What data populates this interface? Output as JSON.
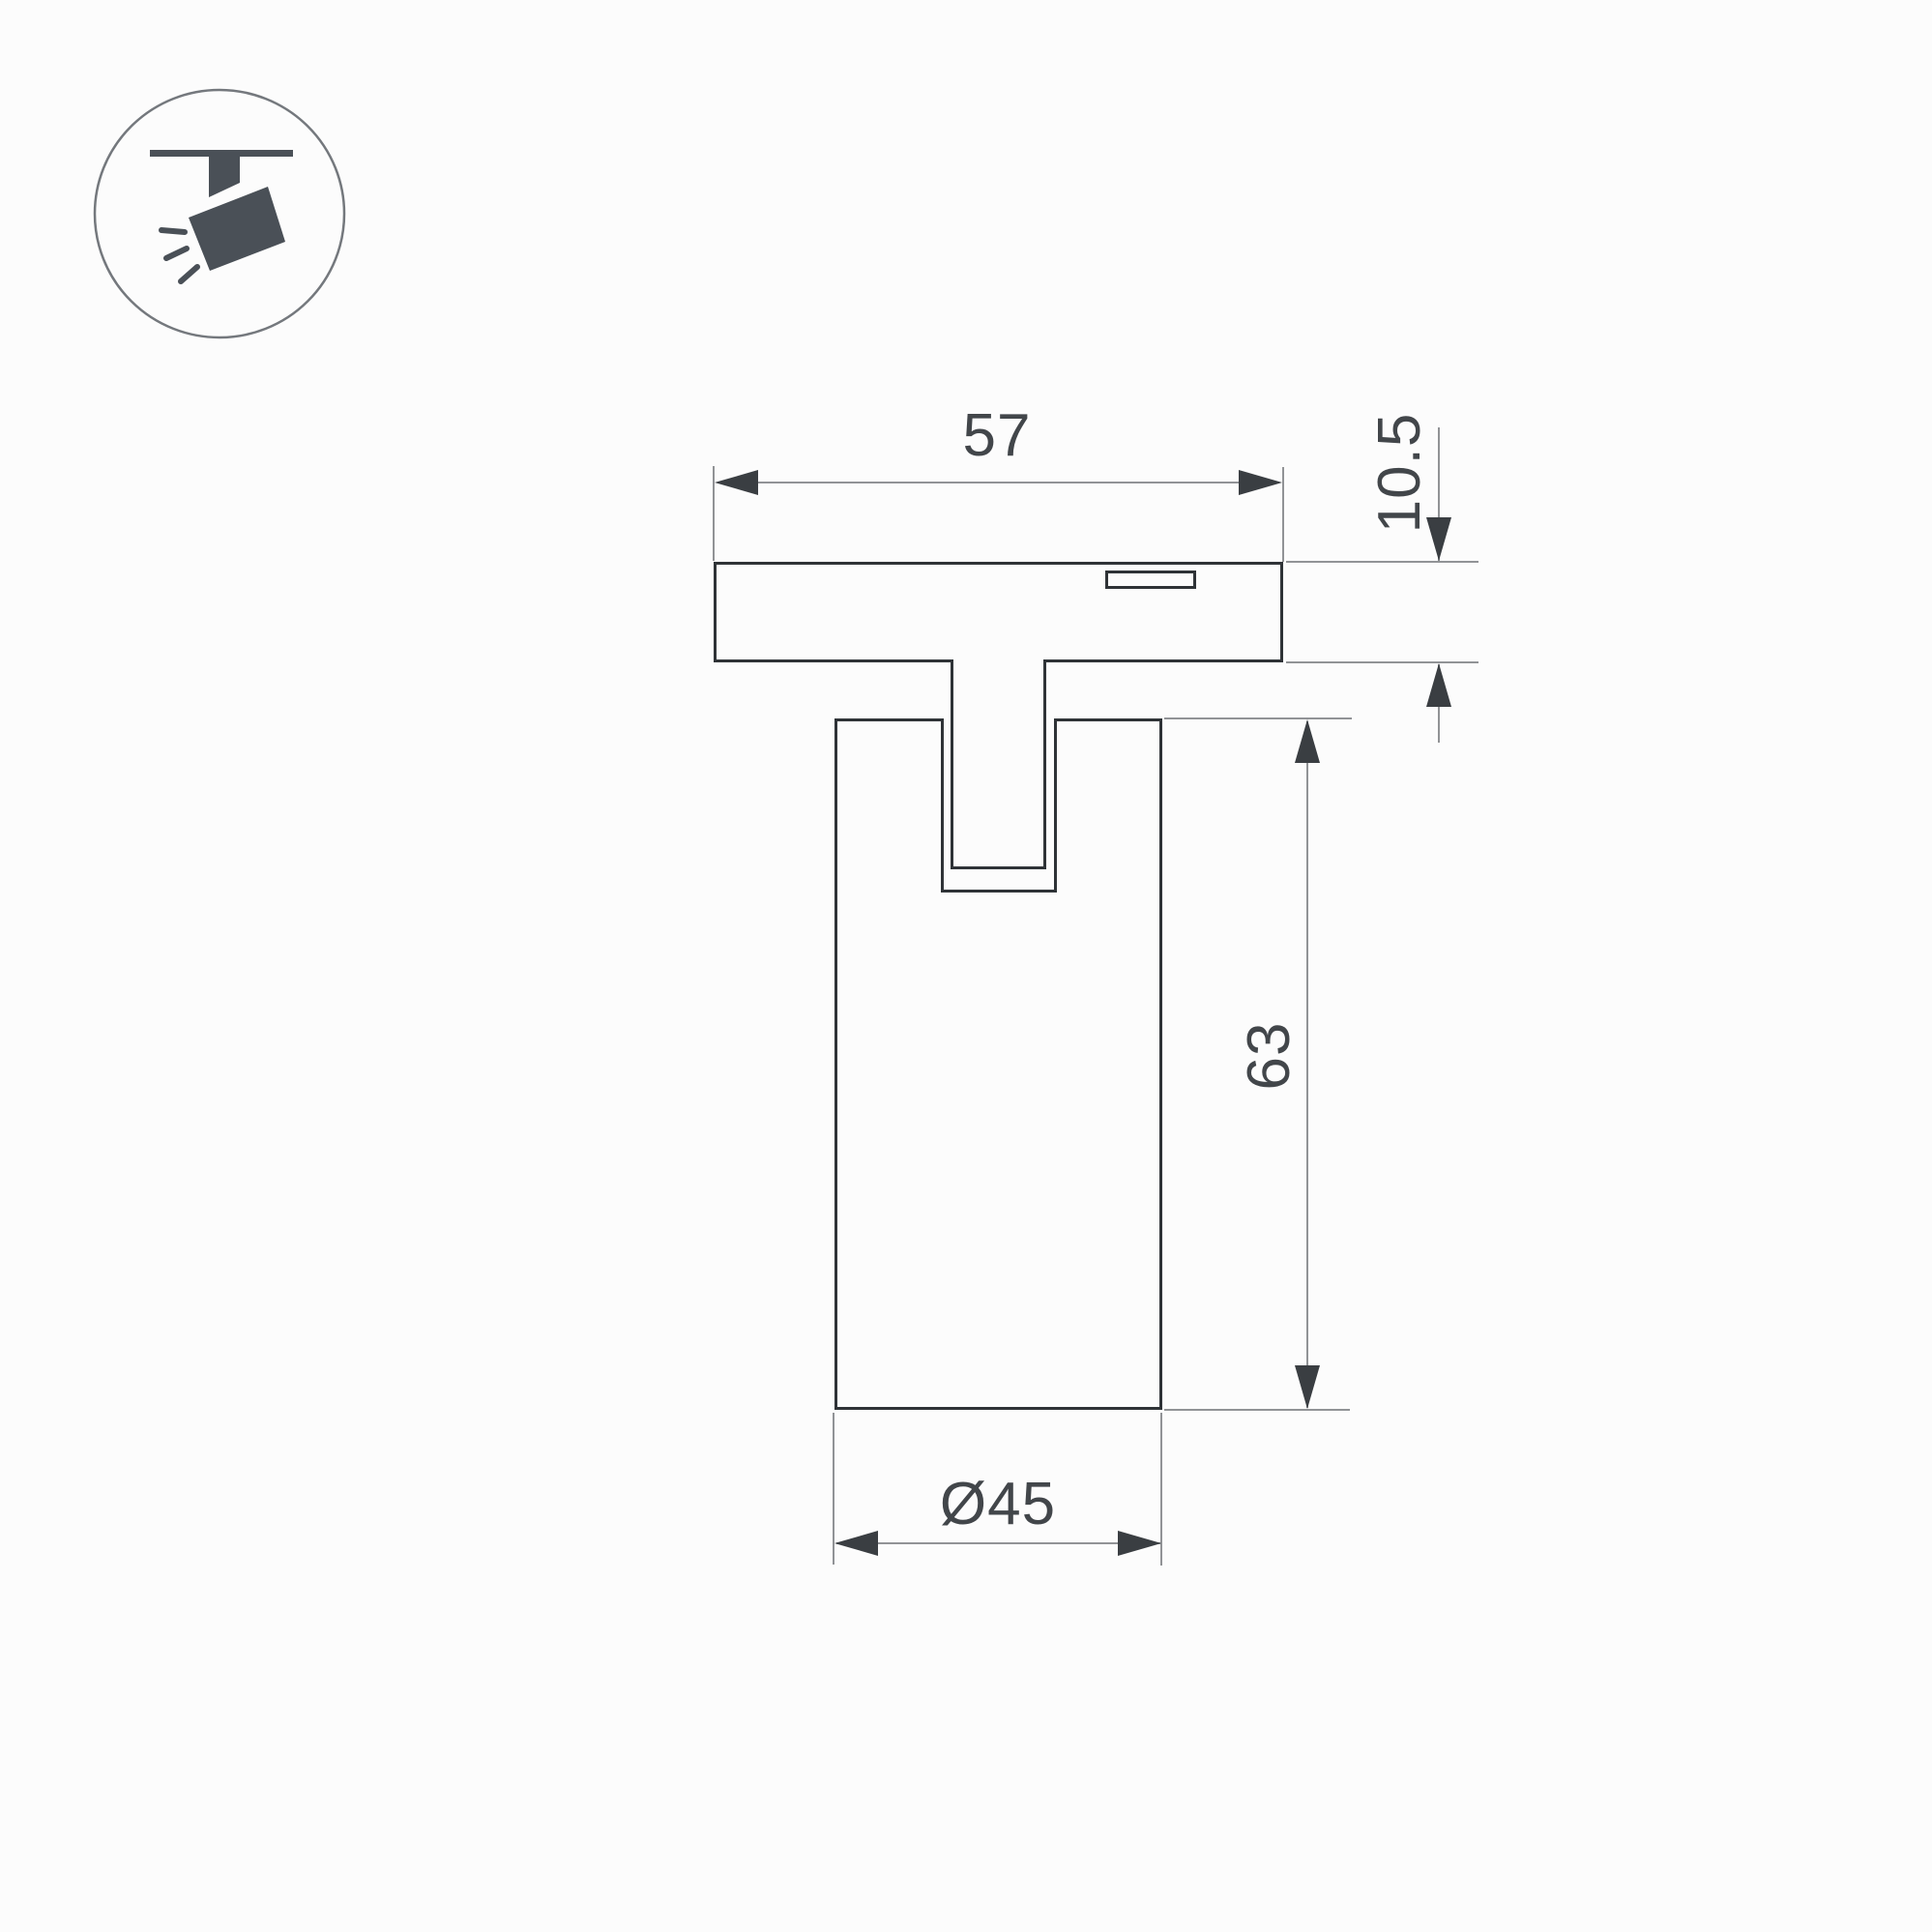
{
  "drawing": {
    "dimensions": {
      "track_width": "57",
      "base_height": "10.5",
      "body_height": "63",
      "body_diameter": "Ø45"
    },
    "icon": {
      "name": "track-spotlight-icon"
    },
    "colors": {
      "background": "#fcfcfc",
      "outline": "#2f3337",
      "dimension_line": "#919396",
      "arrow": "#3a3e42",
      "text": "#42464a",
      "icon_fill": "#4a5057",
      "icon_circle_stroke": "#74787d"
    }
  }
}
